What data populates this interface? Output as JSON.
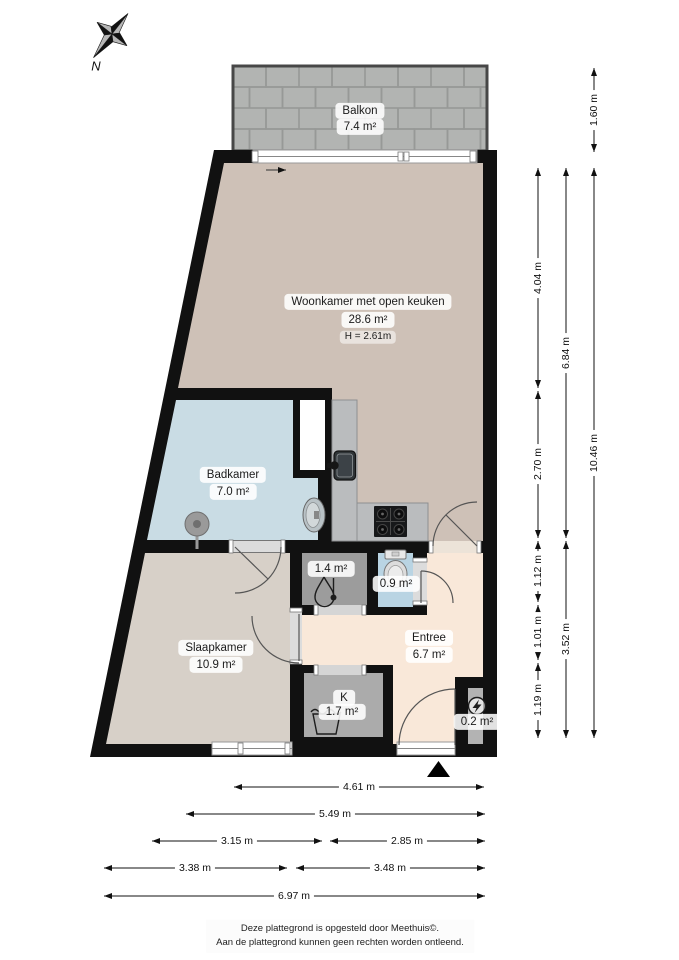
{
  "compass": {
    "north_label": "N"
  },
  "rooms": {
    "balkon": {
      "name": "Balkon",
      "area": "7.4 m²"
    },
    "woonkamer": {
      "name": "Woonkamer met open keuken",
      "area": "28.6 m²",
      "ceiling_height": "H = 2.61m"
    },
    "badkamer": {
      "name": "Badkamer",
      "area": "7.0 m²"
    },
    "slaapkamer": {
      "name": "Slaapkamer",
      "area": "10.9 m²"
    },
    "entree": {
      "name": "Entree",
      "area": "6.7 m²"
    },
    "kast": {
      "name": "K",
      "area": "1.7 m²"
    },
    "boiler_closet": {
      "area": "1.4 m²"
    },
    "toilet_room": {
      "area": "0.9 m²"
    },
    "meterkast": {
      "area": "0.2 m²"
    }
  },
  "dims": {
    "right": [
      "1.60 m",
      "4.04 m",
      "2.70 m",
      "1.12 m",
      "1.01 m",
      "1.19 m",
      "6.84 m",
      "3.52 m",
      "10.46 m"
    ],
    "bottom": [
      "4.61 m",
      "5.49 m",
      "3.15 m",
      "2.85 m",
      "3.38 m",
      "3.48 m",
      "6.97 m"
    ]
  },
  "footer": {
    "line1": "Deze plattegrond is opgesteld door Meethuis©.",
    "line2": "Aan de plattegrond kunnen geen rechten worden ontleend."
  },
  "icons": {
    "compass": "compass-rose-icon",
    "boiler": "boiler-icon",
    "toilet": "toilet-icon",
    "washbasin": "washbasin-icon",
    "shower_drain": "shower-drain-icon",
    "kitchen_sink": "kitchen-sink-icon",
    "stove": "stove-icon",
    "laundry": "laundry-tub-icon",
    "electric_meter": "electric-meter-icon",
    "entrance_marker": "entrance-triangle-icon"
  },
  "colors": {
    "wall": "#111111",
    "woonkamer_floor": "#cec1b7",
    "slaapkamer_floor": "#d7d0c8",
    "badkamer_floor": "#c9dce4",
    "toilet_floor": "#b9d4e3",
    "entree_floor": "#f9e8d9",
    "closet_floor": "#ababab",
    "counter": "#babcbe",
    "balcony_tile": "#b2b4b2"
  }
}
